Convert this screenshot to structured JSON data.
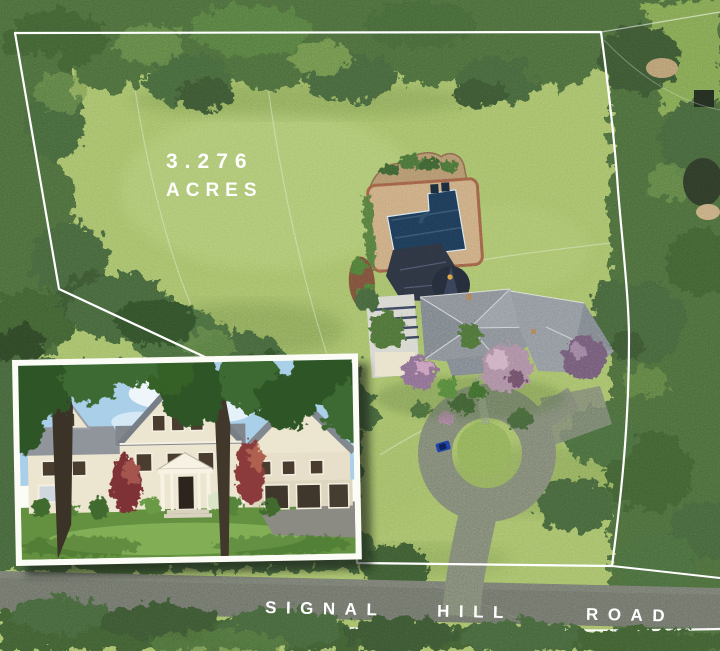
{
  "annotations": {
    "acreage": {
      "value": "3.276",
      "unit": "ACRES"
    },
    "road": {
      "words": [
        "SIGNAL",
        "HILL",
        "ROAD"
      ]
    }
  },
  "colors": {
    "boundary_line": "#ffffff",
    "lawn": "#a3bd68",
    "trees_dark": "#4c6b3b",
    "trees_deep": "#3a5530",
    "trees_bottom": "#3f5d33",
    "neighbor_lawn": "#7fa251",
    "road_asphalt": "#6e7268",
    "driveway": "#7d8472",
    "turnaround_island": "#8fae58",
    "car_blue": "#1e3f9e",
    "pool_water": "#1d3a55",
    "pool_patio": "#c8a87e",
    "patio_border": "#9c5f45",
    "cabana_wall": "#b0926c",
    "roof_main": "#878d94",
    "roof_dark": "#2c3340",
    "turret_roof": "#242b38",
    "label_text": "#ffffff",
    "inset_frame": "#fcfcf7",
    "inset_sky": "#a9cfe9",
    "inset_siding": "#ece5cf",
    "inset_lawn": "#63913f",
    "inset_maple_red": "#7e3034"
  }
}
